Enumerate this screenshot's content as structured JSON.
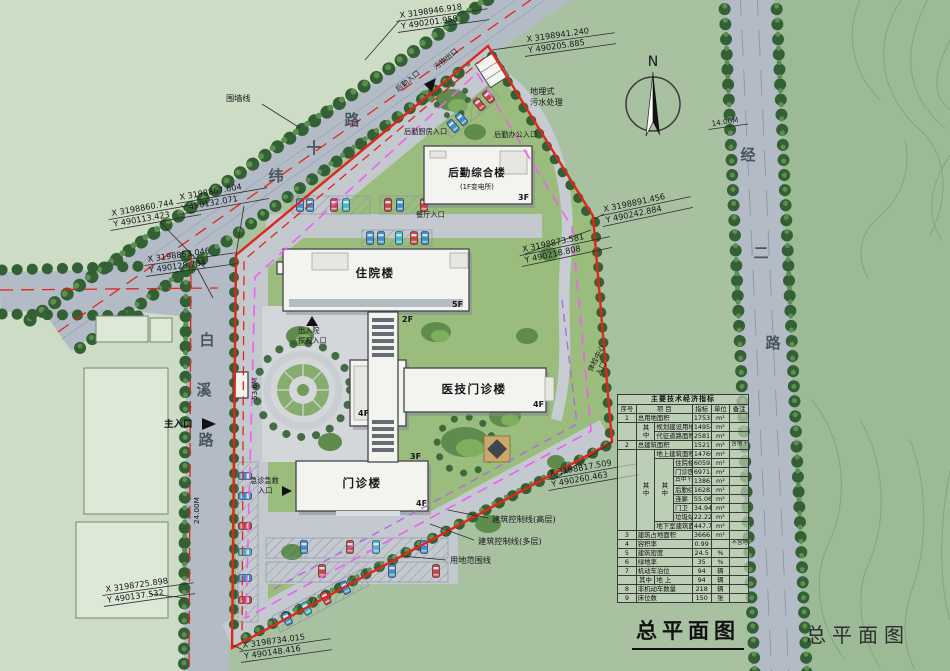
{
  "title_main": "总平面图",
  "title_right": "总平面图",
  "north": "N",
  "roads": {
    "weishi": [
      "纬",
      "十",
      "路"
    ],
    "baixi": [
      "白",
      "溪",
      "路"
    ],
    "jinger": [
      "经",
      "二",
      "路"
    ]
  },
  "buildings": {
    "inpatient": {
      "name": "住院楼",
      "fl": "5F"
    },
    "medtech": {
      "name": "医技门诊楼",
      "fl": "4F"
    },
    "outpatient": {
      "name": "门诊楼",
      "fl": "4F"
    },
    "logistics": {
      "name": "后勤综合楼",
      "sub": "(1F变电所)",
      "fl": "3F"
    },
    "fl_2f": "2F",
    "fl_3f": "3F",
    "fl_4f": "4F"
  },
  "labels": {
    "wall_line": "围墙线",
    "sewage_l1": "地埋式",
    "sewage_l2": "污水处理",
    "ctrl_high": "建筑控制线(高层)",
    "ctrl_multi": "建筑控制线(多层)",
    "site_boundary": "用地范围线",
    "main_entrance": "主入口",
    "emergency_l1": "急诊急救",
    "emergency_l2": "入口",
    "visit_l1": "出入院",
    "visit_l2": "探视入口",
    "logistics_entrance": "后勤入口",
    "waste_exit": "污物出口",
    "kitchen_entrance": "后勤厨房入口",
    "office_entrance": "后勤办公入口",
    "canteen_entrance": "餐厅入口",
    "checkup_l1": "体检中心",
    "checkup_l2": "入口"
  },
  "dims": {
    "jinger_w": "14.00M",
    "baixi_w": "24.00M",
    "frontage": "53.6M"
  },
  "coords": [
    {
      "x": "X 3198946.918",
      "y": "Y 490201.958"
    },
    {
      "x": "X 3198941.240",
      "y": "Y 490205.885"
    },
    {
      "x": "X 3198867.604",
      "y": "Y 490132.071"
    },
    {
      "x": "X 3198860.744",
      "y": "Y 490113.423"
    },
    {
      "x": "X 3198853.046",
      "y": "Y 490128.784"
    },
    {
      "x": "X 3198891.456",
      "y": "Y 490242.884"
    },
    {
      "x": "X 3198873.581",
      "y": "Y 490218.808"
    },
    {
      "x": "X 3198817.509",
      "y": "Y 490260.463"
    },
    {
      "x": "X 3198734.015",
      "y": "Y 490148.416"
    },
    {
      "x": "X 3198725.898",
      "y": "Y 490137.532"
    }
  ],
  "colors": {
    "boundary_red": "#e1251b",
    "control_magenta": "#ef5ff1",
    "control_purple": "#b06ae0",
    "road_gray": "#b3bcc6"
  },
  "table": {
    "rows": [
      [
        {
          "t": "主要技术经济指标",
          "cs": 7,
          "cl": "hd"
        }
      ],
      [
        {
          "t": "序号"
        },
        {
          "t": "项  目",
          "cs": 3
        },
        {
          "t": "指标"
        },
        {
          "t": "单位"
        },
        {
          "t": "备注"
        }
      ],
      [
        {
          "t": "1"
        },
        {
          "t": "总用地面积",
          "cs": 3,
          "cl": "l"
        },
        {
          "t": "17535"
        },
        {
          "t": "m²"
        },
        {
          "t": ""
        }
      ],
      [
        {
          "t": "",
          "rs": 2
        },
        {
          "t": "其中",
          "rs": 2,
          "cl": "v"
        },
        {
          "t": "规划建设用地",
          "cs": 2,
          "cl": "l"
        },
        {
          "t": "14954"
        },
        {
          "t": "m²"
        },
        {
          "t": ""
        }
      ],
      [
        {
          "t": "代征道路面积",
          "cs": 2,
          "cl": "l"
        },
        {
          "t": "2581"
        },
        {
          "t": "m²"
        },
        {
          "t": ""
        }
      ],
      [
        {
          "t": "2"
        },
        {
          "t": "总建筑面积",
          "cs": 3,
          "cl": "l"
        },
        {
          "t": "15217.15"
        },
        {
          "t": "m²"
        },
        {
          "t": "含地下室",
          "cl": "nt"
        }
      ],
      [
        {
          "t": "",
          "rs": 9
        },
        {
          "t": "其中",
          "rs": 9,
          "cl": "v"
        },
        {
          "t": "地上建筑面积",
          "cs": 2,
          "cl": "l"
        },
        {
          "t": "14769.41"
        },
        {
          "t": "m²"
        },
        {
          "t": ""
        }
      ],
      [
        {
          "t": "其中",
          "rs": 7,
          "cl": "v"
        },
        {
          "t": "住院楼",
          "cl": "l"
        },
        {
          "t": "6059.09"
        },
        {
          "t": "m²"
        },
        {
          "t": ""
        }
      ],
      [
        {
          "t": "门诊医技楼",
          "cl": "l"
        },
        {
          "t": "6971.24"
        },
        {
          "t": "m²"
        },
        {
          "t": ""
        }
      ],
      [
        {
          "t": "其中 行政管理用房",
          "cl": "l nt"
        },
        {
          "t": "1386.58"
        },
        {
          "t": "m²"
        },
        {
          "t": ""
        }
      ],
      [
        {
          "t": "后勤综合楼",
          "cl": "l"
        },
        {
          "t": "1628.88"
        },
        {
          "t": "m²"
        },
        {
          "t": ""
        }
      ],
      [
        {
          "t": "连廊",
          "cl": "l"
        },
        {
          "t": "55.06"
        },
        {
          "t": "m²"
        },
        {
          "t": ""
        }
      ],
      [
        {
          "t": "门卫",
          "cl": "l"
        },
        {
          "t": "34.94"
        },
        {
          "t": "m²"
        },
        {
          "t": ""
        }
      ],
      [
        {
          "t": "垃圾站",
          "cl": "l"
        },
        {
          "t": "22.22"
        },
        {
          "t": "m²"
        },
        {
          "t": ""
        }
      ],
      [
        {
          "t": "地下室建筑面积",
          "cs": 2,
          "cl": "l"
        },
        {
          "t": "447.74"
        },
        {
          "t": "m²"
        },
        {
          "t": ""
        }
      ],
      [
        {
          "t": "3"
        },
        {
          "t": "建筑占地面积",
          "cs": 3,
          "cl": "l"
        },
        {
          "t": "3666.84"
        },
        {
          "t": "m²"
        },
        {
          "t": ""
        }
      ],
      [
        {
          "t": "4"
        },
        {
          "t": "容积率",
          "cs": 3,
          "cl": "l"
        },
        {
          "t": "0.99"
        },
        {
          "t": ""
        },
        {
          "t": "不含地下室",
          "cl": "nt"
        }
      ],
      [
        {
          "t": "5"
        },
        {
          "t": "建筑密度",
          "cs": 3,
          "cl": "l"
        },
        {
          "t": "24.5"
        },
        {
          "t": "%"
        },
        {
          "t": ""
        }
      ],
      [
        {
          "t": "6"
        },
        {
          "t": "绿地率",
          "cs": 3,
          "cl": "l"
        },
        {
          "t": "35"
        },
        {
          "t": "%"
        },
        {
          "t": ""
        }
      ],
      [
        {
          "t": "7"
        },
        {
          "t": "机动车泊位",
          "cs": 3,
          "cl": "l"
        },
        {
          "t": "94"
        },
        {
          "t": "辆"
        },
        {
          "t": ""
        }
      ],
      [
        {
          "t": ""
        },
        {
          "t": "其中"
        },
        {
          "t": "地  上",
          "cs": 2,
          "cl": "l"
        },
        {
          "t": "94"
        },
        {
          "t": "辆"
        },
        {
          "t": ""
        }
      ],
      [
        {
          "t": "8"
        },
        {
          "t": "非机动车数量",
          "cs": 3,
          "cl": "l"
        },
        {
          "t": "218"
        },
        {
          "t": "辆"
        },
        {
          "t": ""
        }
      ],
      [
        {
          "t": "9"
        },
        {
          "t": "床位数",
          "cs": 3,
          "cl": "l"
        },
        {
          "t": "150"
        },
        {
          "t": "张"
        },
        {
          "t": ""
        }
      ]
    ]
  }
}
